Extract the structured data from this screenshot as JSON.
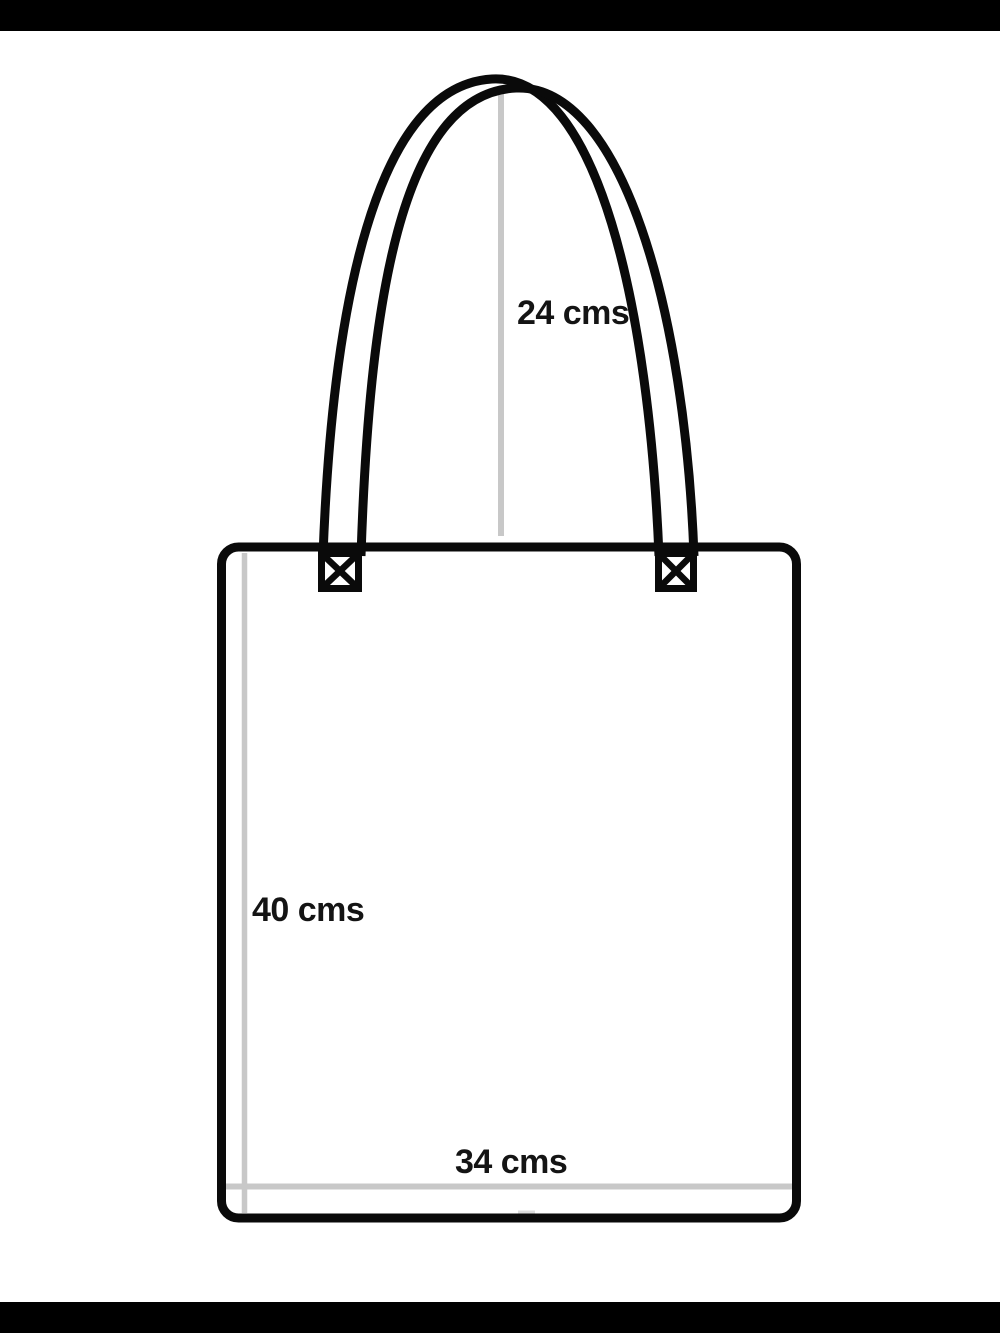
{
  "page": {
    "kind": "tote-bag-dimension-diagram",
    "background_color": "#ffffff",
    "letterbox_color": "#000000"
  },
  "diagram": {
    "outline_color": "#0a0a0a",
    "measure_line_color": "#c8c8c8",
    "labels": {
      "handle_height": "24 cms",
      "bag_height": "40 cms",
      "bag_width": "34 cms"
    },
    "parts": {
      "bag_body": "bag front panel",
      "handle": "shoulder strap",
      "attachments": "stitched x-box strap attachments"
    }
  }
}
